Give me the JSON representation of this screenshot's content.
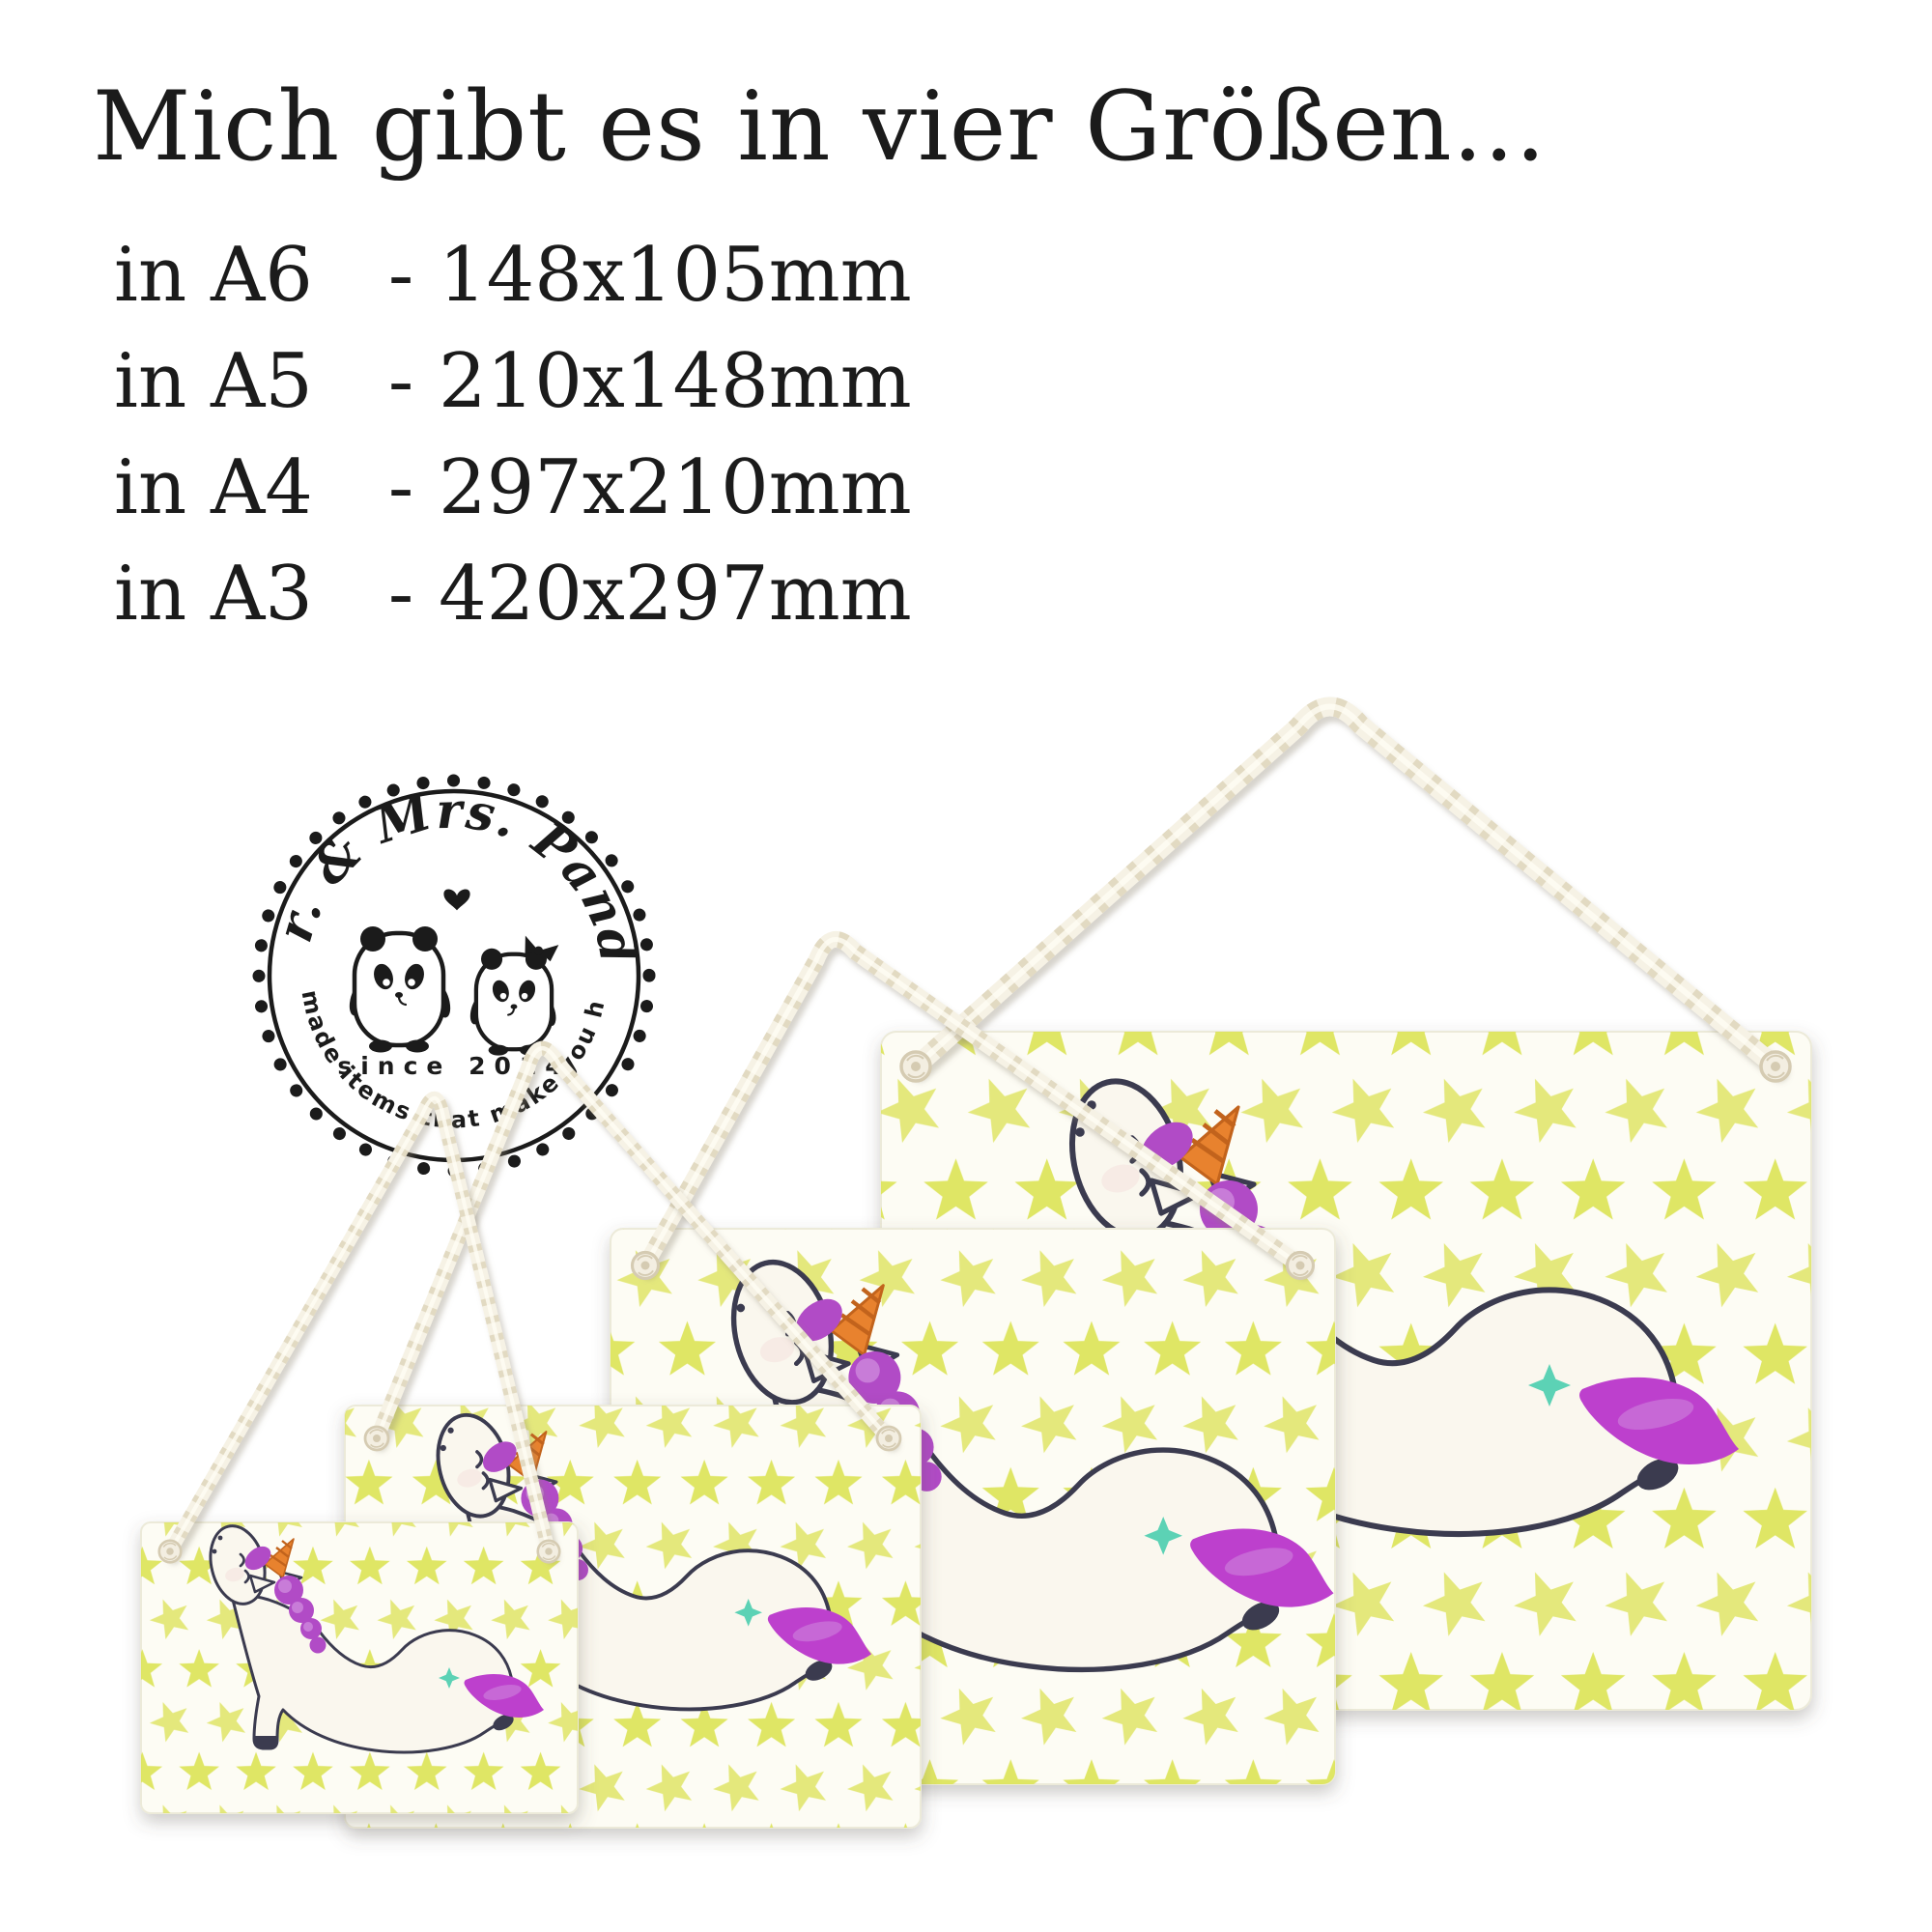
{
  "headline": {
    "text": "Mich gibt es in vier Größen..."
  },
  "size_list": {
    "rows": [
      {
        "label": "in A6",
        "separator": "-",
        "dimensions": "148x105mm"
      },
      {
        "label": "in A5",
        "separator": "-",
        "dimensions": "210x148mm"
      },
      {
        "label": "in A4",
        "separator": "-",
        "dimensions": "297x210mm"
      },
      {
        "label": "in A3",
        "separator": "-",
        "dimensions": "420x297mm"
      }
    ]
  },
  "logo": {
    "brand_arc": "Mr. & Mrs. Panda",
    "since_badge": "since 2014",
    "tagline_arc": "Handmade items that make you happy!"
  },
  "icons": {
    "heart": "♥",
    "star": "★",
    "sparkle": "✦"
  },
  "colors": {
    "ink": "#1b1b1b",
    "text": "#1b1b1b",
    "star": "#dde45e",
    "plaque": "#fdfcf4",
    "plaque_edge": "#ecead9",
    "outline": "#3b3b4f",
    "body": "#faf7ee",
    "blush": "#f4e2de",
    "mane": "#b14cc6",
    "mane_light": "#d28fe0",
    "tail": "#bd40cd",
    "horn": "#e8822e",
    "horn_stripe": "#c2641c",
    "sparkle": "#5bd2b5",
    "rope": "#f6f2e5",
    "rope_twist": "#ddd3b9",
    "rope_shadow": "#8c8270",
    "eyelet": "#f3eee1",
    "eyelet_ring": "#d5cbb2"
  }
}
